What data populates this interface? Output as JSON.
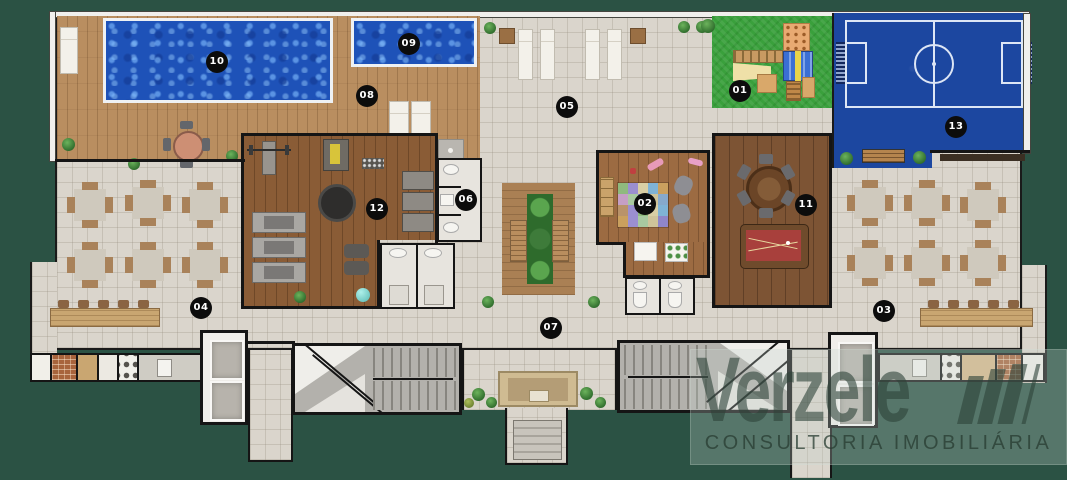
{
  "watermark": {
    "brand": "Verzele",
    "tagline": "CONSULTORIA IMOBILIÁRIA"
  },
  "areas": [
    {
      "number": "01",
      "label": "playground"
    },
    {
      "number": "02",
      "label": "kids-room"
    },
    {
      "number": "03",
      "label": "right-terrace-tables"
    },
    {
      "number": "04",
      "label": "left-terrace-tables"
    },
    {
      "number": "05",
      "label": "sun-deck"
    },
    {
      "number": "06",
      "label": "restrooms"
    },
    {
      "number": "07",
      "label": "central-hall"
    },
    {
      "number": "08",
      "label": "pool-deck"
    },
    {
      "number": "09",
      "label": "kids-pool"
    },
    {
      "number": "10",
      "label": "main-pool"
    },
    {
      "number": "11",
      "label": "games-room"
    },
    {
      "number": "12",
      "label": "gym"
    },
    {
      "number": "13",
      "label": "sports-court"
    }
  ],
  "palette": {
    "background": "#2b5244",
    "pool_water": "#1e52b8",
    "court_blue": "#1c47a0",
    "grass": "#3aa03c",
    "wood_deck": "#b98e60",
    "tile": "#dad5cc",
    "wall": "#151515",
    "kids_mat": [
      "#8fba7e",
      "#9b8fd0",
      "#d9cfa5",
      "#7fb3d6",
      "#caa05e",
      "#c59fc5",
      "#a8c9a0",
      "#8f86c9",
      "#cfc49a",
      "#86a9cc",
      "#b9936a",
      "#9b8fd0",
      "#8fba7e",
      "#d9cfa5",
      "#7fb3d6",
      "#caa05e",
      "#9b8fd0",
      "#a8c9a0",
      "#cfc49a",
      "#8f86c9"
    ]
  }
}
